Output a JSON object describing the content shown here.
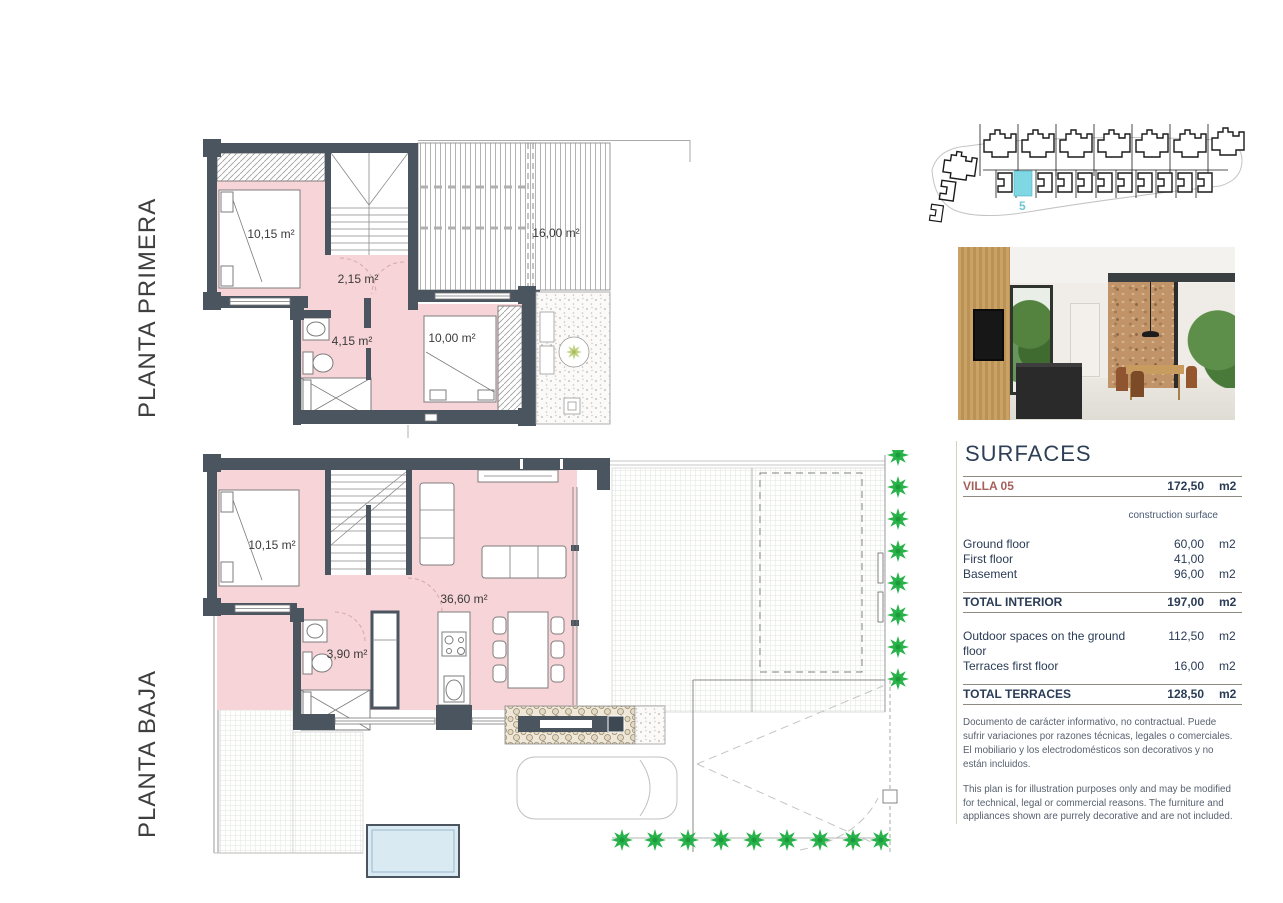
{
  "plans": {
    "first_floor": {
      "label": "PLANTA PRIMERA",
      "rooms": {
        "bedroom1": "10,15 m²",
        "hall": "2,15 m²",
        "bathroom": "4,15 m²",
        "bedroom2": "10,00 m²",
        "terrace": "16,00 m²"
      }
    },
    "ground_floor": {
      "label": "PLANTA BAJA",
      "rooms": {
        "bedroom": "10,15 m²",
        "bathroom": "3,90 m²",
        "living": "36,60 m²"
      }
    }
  },
  "site_plan": {
    "highlighted_villa_number": "5",
    "highlight_color": "#7ed7e3"
  },
  "surfaces": {
    "title": "SURFACES",
    "villa_row": {
      "label": "VILLA 05",
      "value": "172,50",
      "unit": "m2"
    },
    "column_header": "construction surface",
    "interior_rows": [
      {
        "label": "Ground floor",
        "value": "60,00",
        "unit": "m2"
      },
      {
        "label": "First floor",
        "value": "41,00",
        "unit": ""
      },
      {
        "label": "Basement",
        "value": "96,00",
        "unit": "m2"
      }
    ],
    "total_interior": {
      "label": "TOTAL INTERIOR",
      "value": "197,00",
      "unit": "m2"
    },
    "terrace_rows": [
      {
        "label": "Outdoor spaces on the ground floor",
        "value": "112,50",
        "unit": "m2"
      },
      {
        "label": "Terraces first floor",
        "value": "16,00",
        "unit": "m2"
      }
    ],
    "total_terraces": {
      "label": "TOTAL TERRACES",
      "value": "128,50",
      "unit": "m2"
    },
    "disclaimer_es": "Documento de carácter informativo, no contractual. Puede sufrir variaciones por razones técnicas, legales o comerciales. El mobiliario y los electrodomésticos son decorativos y no están incluidos.",
    "disclaimer_en": "This plan is for illustration purposes only and may be modified for technical, legal or commercial reasons. The furniture and appliances shown are purrely decorative and are not included."
  },
  "colors": {
    "wall": "#4a5560",
    "room_fill": "#f7d4d7",
    "accent_red": "#a5615c",
    "text_navy": "#2a3b55",
    "tree_green": "#27b34a",
    "pool_fill": "#d9eaf3"
  }
}
